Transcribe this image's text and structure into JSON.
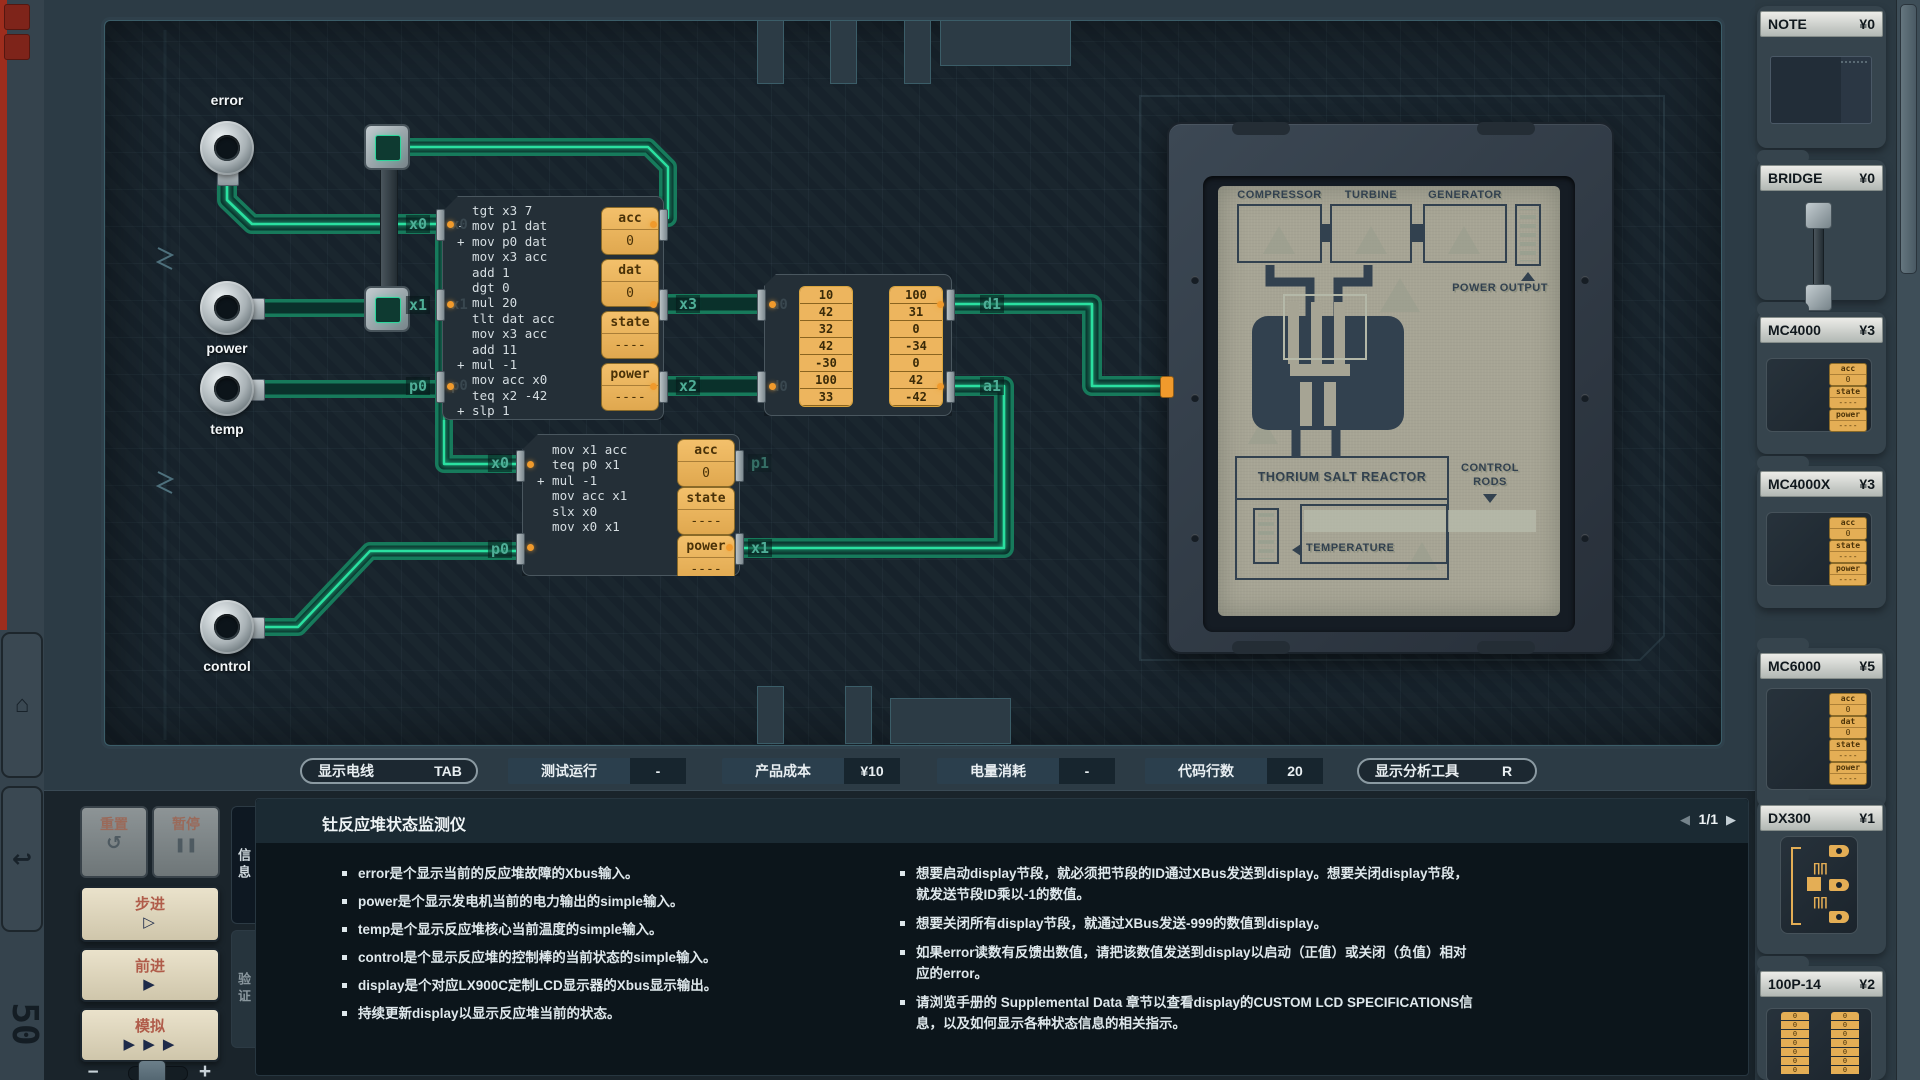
{
  "icons": {
    "home": "⌂",
    "undo": "↩",
    "logo": "50",
    "reset": "↺",
    "pause": "❚❚",
    "step": "▷",
    "advance": "▶",
    "simulate": "▶ ▶ ▶",
    "pager_prev": "◀",
    "pager_next": "▶",
    "minus": "−",
    "plus": "+",
    "pulse": "∏",
    "arrow_up": "▲",
    "arrow_down": "▼",
    "arrow_left": "◀"
  },
  "pins": {
    "error": "error",
    "power": "power",
    "temp": "temp",
    "control": "control"
  },
  "chips": {
    "chip1": {
      "code": [
        "  tgt x3 7",
        "- mov p1 dat",
        "+ mov p0 dat",
        "  mov x3 acc",
        "  add 1",
        "  dgt 0",
        "  mul 20",
        "  tlt dat acc",
        "  mov x3 acc",
        "  add 11",
        "+ mul -1",
        "  mov acc x0",
        "  teq x2 -42",
        "+ slp 1"
      ],
      "registers": [
        {
          "name": "acc",
          "value": "0"
        },
        {
          "name": "dat",
          "value": "0"
        },
        {
          "name": "state",
          "value": "----"
        },
        {
          "name": "power",
          "value": "----"
        }
      ]
    },
    "chip2": {
      "code": [
        "  mov x1 acc",
        "  teq p0 x1",
        "+ mul -1",
        "  mov acc x1",
        "  slx x0",
        "  mov x0 x1"
      ],
      "registers": [
        {
          "name": "acc",
          "value": "0"
        },
        {
          "name": "state",
          "value": "----"
        },
        {
          "name": "power",
          "value": "----"
        }
      ]
    }
  },
  "ram": {
    "col1": [
      "10",
      "42",
      "32",
      "42",
      "-30",
      "100",
      "33"
    ],
    "col2": [
      "100",
      "31",
      "0",
      "-34",
      "0",
      "42",
      "-42"
    ],
    "ghost_ports": [
      "a0",
      "d0",
      "d1",
      "a1"
    ]
  },
  "wire_labels": [
    {
      "id": "c1x0",
      "text": "x0"
    },
    {
      "id": "c1x1",
      "text": "x1"
    },
    {
      "id": "c1p0",
      "text": "p0"
    },
    {
      "id": "c1x3",
      "text": "x3"
    },
    {
      "id": "c1x2",
      "text": "x2"
    },
    {
      "id": "rd1",
      "text": "d1"
    },
    {
      "id": "ra1",
      "text": "a1"
    },
    {
      "id": "c2x0",
      "text": "x0"
    },
    {
      "id": "c2p0",
      "text": "p0"
    },
    {
      "id": "c2x1",
      "text": "x1"
    },
    {
      "id": "c2p1",
      "text": "p1"
    }
  ],
  "display": {
    "compressor": "COMPRESSOR",
    "turbine": "TURBINE",
    "generator": "GENERATOR",
    "power_output": "POWER OUTPUT",
    "reactor": "THORIUM SALT REACTOR",
    "control_rods_line1": "CONTROL",
    "control_rods_line2": "RODS",
    "temperature": "TEMPERATURE"
  },
  "statusbar": [
    {
      "label": "显示电线",
      "value": "TAB",
      "style": "outline"
    },
    {
      "label": "测试运行",
      "value": "-",
      "style": "solid"
    },
    {
      "label": "产品成本",
      "value": "¥10",
      "style": "solid"
    },
    {
      "label": "电量消耗",
      "value": "-",
      "style": "solid"
    },
    {
      "label": "代码行数",
      "value": "20",
      "style": "solid"
    },
    {
      "label": "显示分析工具",
      "value": "R",
      "style": "outline"
    }
  ],
  "controls": {
    "reset": "重置",
    "pause": "暂停",
    "step": "步进",
    "advance": "前进",
    "simulate": "模拟"
  },
  "info_panel": {
    "title": "钍反应堆状态监测仪",
    "pager": "1/1",
    "tabs": [
      "信息",
      "验证"
    ],
    "left_bullets": [
      "error是个显示当前的反应堆故障的Xbus输入。",
      "power是个显示发电机当前的电力输出的simple输入。",
      "temp是个显示反应堆核心当前温度的simple输入。",
      "control是个显示反应堆的控制棒的当前状态的simple输入。",
      "display是个对应LX900C定制LCD显示器的Xbus显示输出。",
      "持续更新display以显示反应堆当前的状态。"
    ],
    "right_bullets": [
      "想要启动display节段，就必须把节段的ID通过XBus发送到display。想要关闭display节段，就发送节段ID乘以-1的数值。",
      "想要关闭所有display节段，就通过XBus发送-999的数值到display。",
      "如果error读数有反馈出数值，请把该数值发送到display以启动（正值）或关闭（负值）相对应的error。",
      "请浏览手册的 Supplemental Data 章节以查看display的CUSTOM LCD SPECIFICATIONS信息，以及如何显示各种状态信息的相关指示。"
    ]
  },
  "sidebar": {
    "parts": [
      {
        "name": "NOTE",
        "price": "¥0",
        "type": "note"
      },
      {
        "name": "BRIDGE",
        "price": "¥0",
        "type": "bridge"
      },
      {
        "name": "MC4000",
        "price": "¥3",
        "type": "mc3"
      },
      {
        "name": "MC4000X",
        "price": "¥3",
        "type": "mc3"
      },
      {
        "name": "MC6000",
        "price": "¥5",
        "type": "mc4"
      },
      {
        "name": "DX300",
        "price": "¥1",
        "type": "dx"
      },
      {
        "name": "100P-14",
        "price": "¥2",
        "type": "ram"
      }
    ],
    "mini_registers": {
      "mc3": [
        [
          "acc",
          "0"
        ],
        [
          "state",
          "----"
        ],
        [
          "power",
          "----"
        ]
      ],
      "mc4": [
        [
          "acc",
          "0"
        ],
        [
          "dat",
          "0"
        ],
        [
          "state",
          "----"
        ],
        [
          "power",
          "----"
        ]
      ]
    },
    "ram_cell": "0"
  },
  "colors": {
    "wire_core": "#2ce0a0",
    "accent_orange": "#f09a2c",
    "lcd_bg": "#a6a494",
    "red_stripe": "#9e2d1d"
  }
}
